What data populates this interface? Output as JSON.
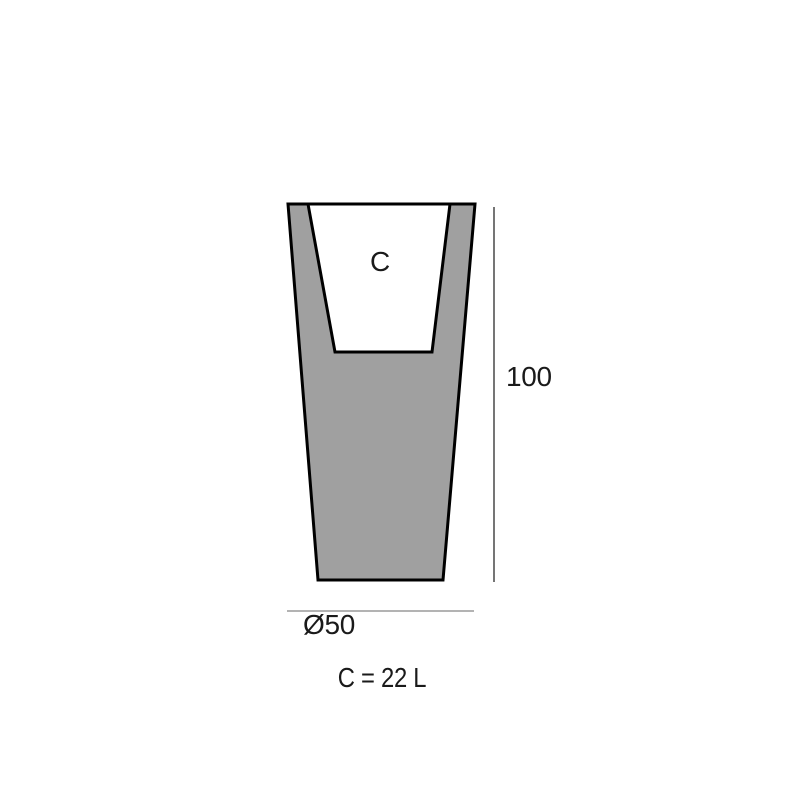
{
  "diagram": {
    "type": "product-dimension-drawing",
    "subject": "tapered-planter-cross-section",
    "labels": {
      "cavity": "C",
      "height": "100",
      "diameter": "Ø50",
      "capacity": "C = 22 L"
    },
    "colors": {
      "body_fill": "#a0a0a0",
      "cavity_fill": "#ffffff",
      "outline": "#000000",
      "height_dim_line": "#757575",
      "diameter_dim_line": "#b3b3b3",
      "background": "#ffffff",
      "text": "#1a1a1a"
    }
  }
}
